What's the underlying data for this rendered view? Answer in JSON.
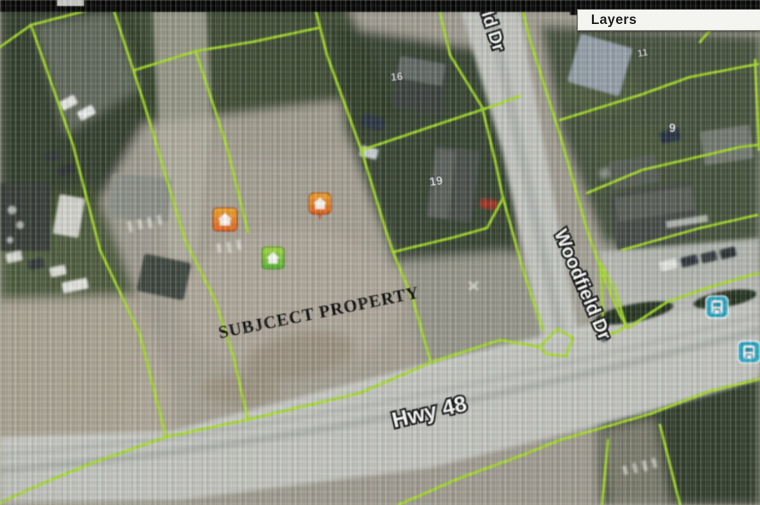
{
  "layers_panel": {
    "title": "Layers"
  },
  "map": {
    "annotation": {
      "subject_property": "SUBJCECT PROPERTY"
    },
    "road_labels": {
      "hwy48": "Hwy 48",
      "woodfield_dr": "Woodfield Dr",
      "woodfield_dr_partial": "eld Dr"
    },
    "house_numbers": {
      "h16": "16",
      "h19": "19",
      "h11": "11",
      "h9": "9"
    },
    "markers": {
      "orange_home_1": "home",
      "orange_home_2": "home",
      "green_home": "home",
      "transit_stop_1": "bus",
      "transit_stop_2": "bus"
    },
    "colors": {
      "parcel_line": "#a6e11c",
      "marker_orange": "#e8641c",
      "marker_orange_light": "#f5a623",
      "marker_green": "#57b52c",
      "marker_green_light": "#a5d93c",
      "marker_blue": "#18a8c8",
      "road_surface": "#c6c7c2"
    }
  }
}
